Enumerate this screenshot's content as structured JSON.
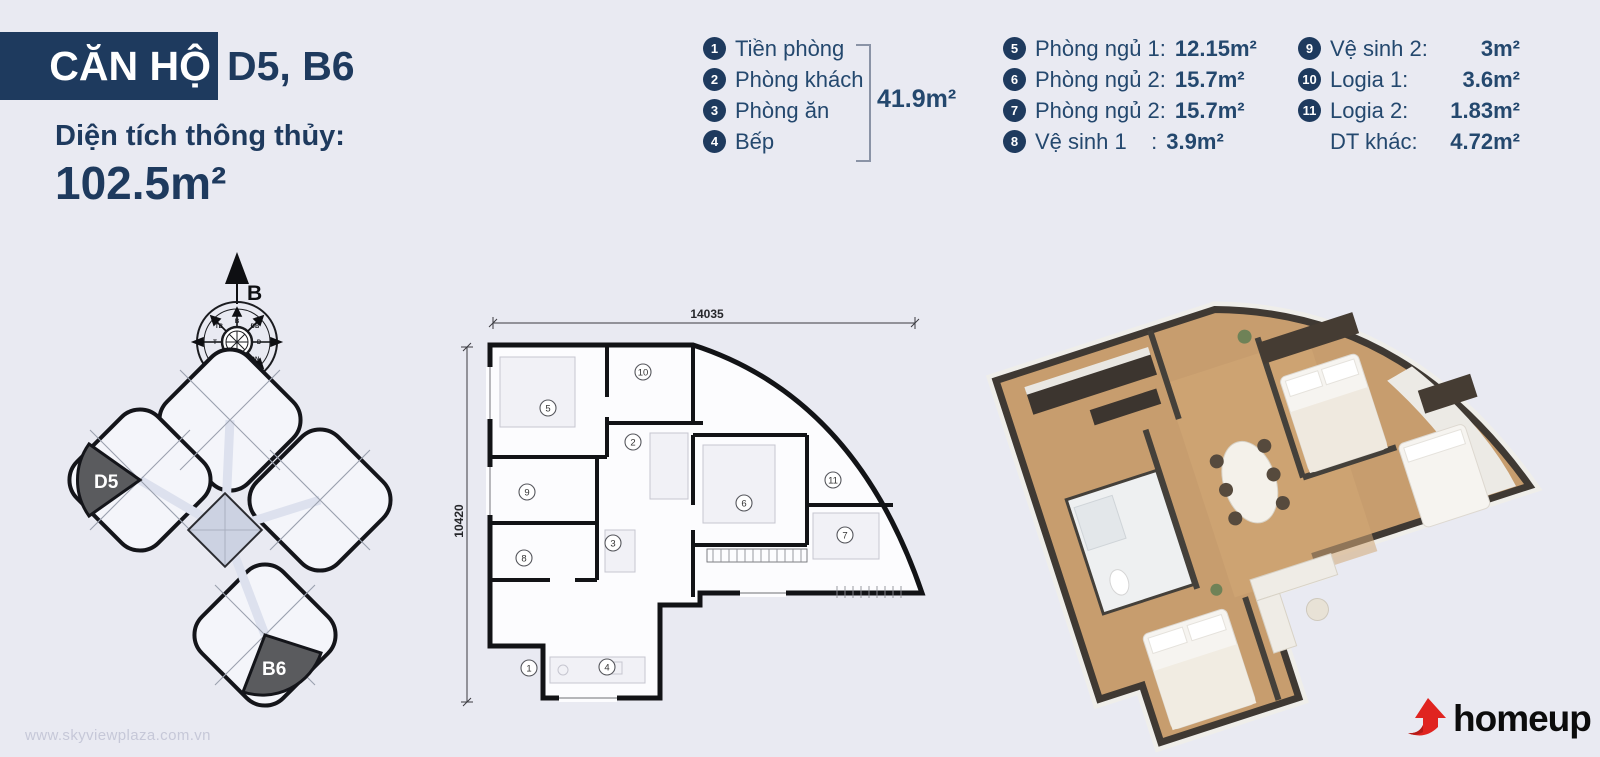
{
  "page": {
    "background": "#e9eaf2",
    "watermark": "www.skyviewplaza.com.vn"
  },
  "header": {
    "title_box": "CĂN HỘ",
    "title_units": "D5, B6",
    "area_label": "Diện tích thông thủy:",
    "area_value": "102.5m²"
  },
  "legend": {
    "group1": {
      "items": [
        {
          "num": "1",
          "label": "Tiền phòng"
        },
        {
          "num": "2",
          "label": "Phòng khách"
        },
        {
          "num": "3",
          "label": "Phòng ăn"
        },
        {
          "num": "4",
          "label": "Bếp"
        }
      ],
      "total": "41.9m²"
    },
    "group2": {
      "items": [
        {
          "num": "5",
          "label": "Phòng ngủ 1:",
          "value": "12.15m²"
        },
        {
          "num": "6",
          "label": "Phòng ngủ 2:",
          "value": "15.7m²"
        },
        {
          "num": "7",
          "label": "Phòng ngủ 2:",
          "value": "15.7m²"
        },
        {
          "num": "8",
          "label": "Vệ sinh 1    :",
          "value": "3.9m²"
        }
      ]
    },
    "group3": {
      "items": [
        {
          "num": "9",
          "label": "Vệ sinh 2:",
          "value": "3m²"
        },
        {
          "num": "10",
          "label": "Logia 1:",
          "value": "3.6m²"
        },
        {
          "num": "11",
          "label": "Logia 2:",
          "value": "1.83m²"
        },
        {
          "num": "",
          "label": "DT khác:",
          "value": "4.72m²"
        }
      ]
    }
  },
  "site_plan": {
    "unit_d5": "D5",
    "unit_b6": "B6",
    "compass": {
      "main": "B",
      "points": [
        "B",
        "ĐB",
        "Đ",
        "ĐN",
        "N",
        "TN",
        "T",
        "TB"
      ]
    }
  },
  "floor_plan_2d": {
    "dim_width": "14035",
    "dim_height": "10420",
    "markers": [
      "1",
      "2",
      "3",
      "4",
      "5",
      "6",
      "7",
      "8",
      "9",
      "10",
      "11"
    ]
  },
  "branding": {
    "logo_text": "homeup"
  }
}
